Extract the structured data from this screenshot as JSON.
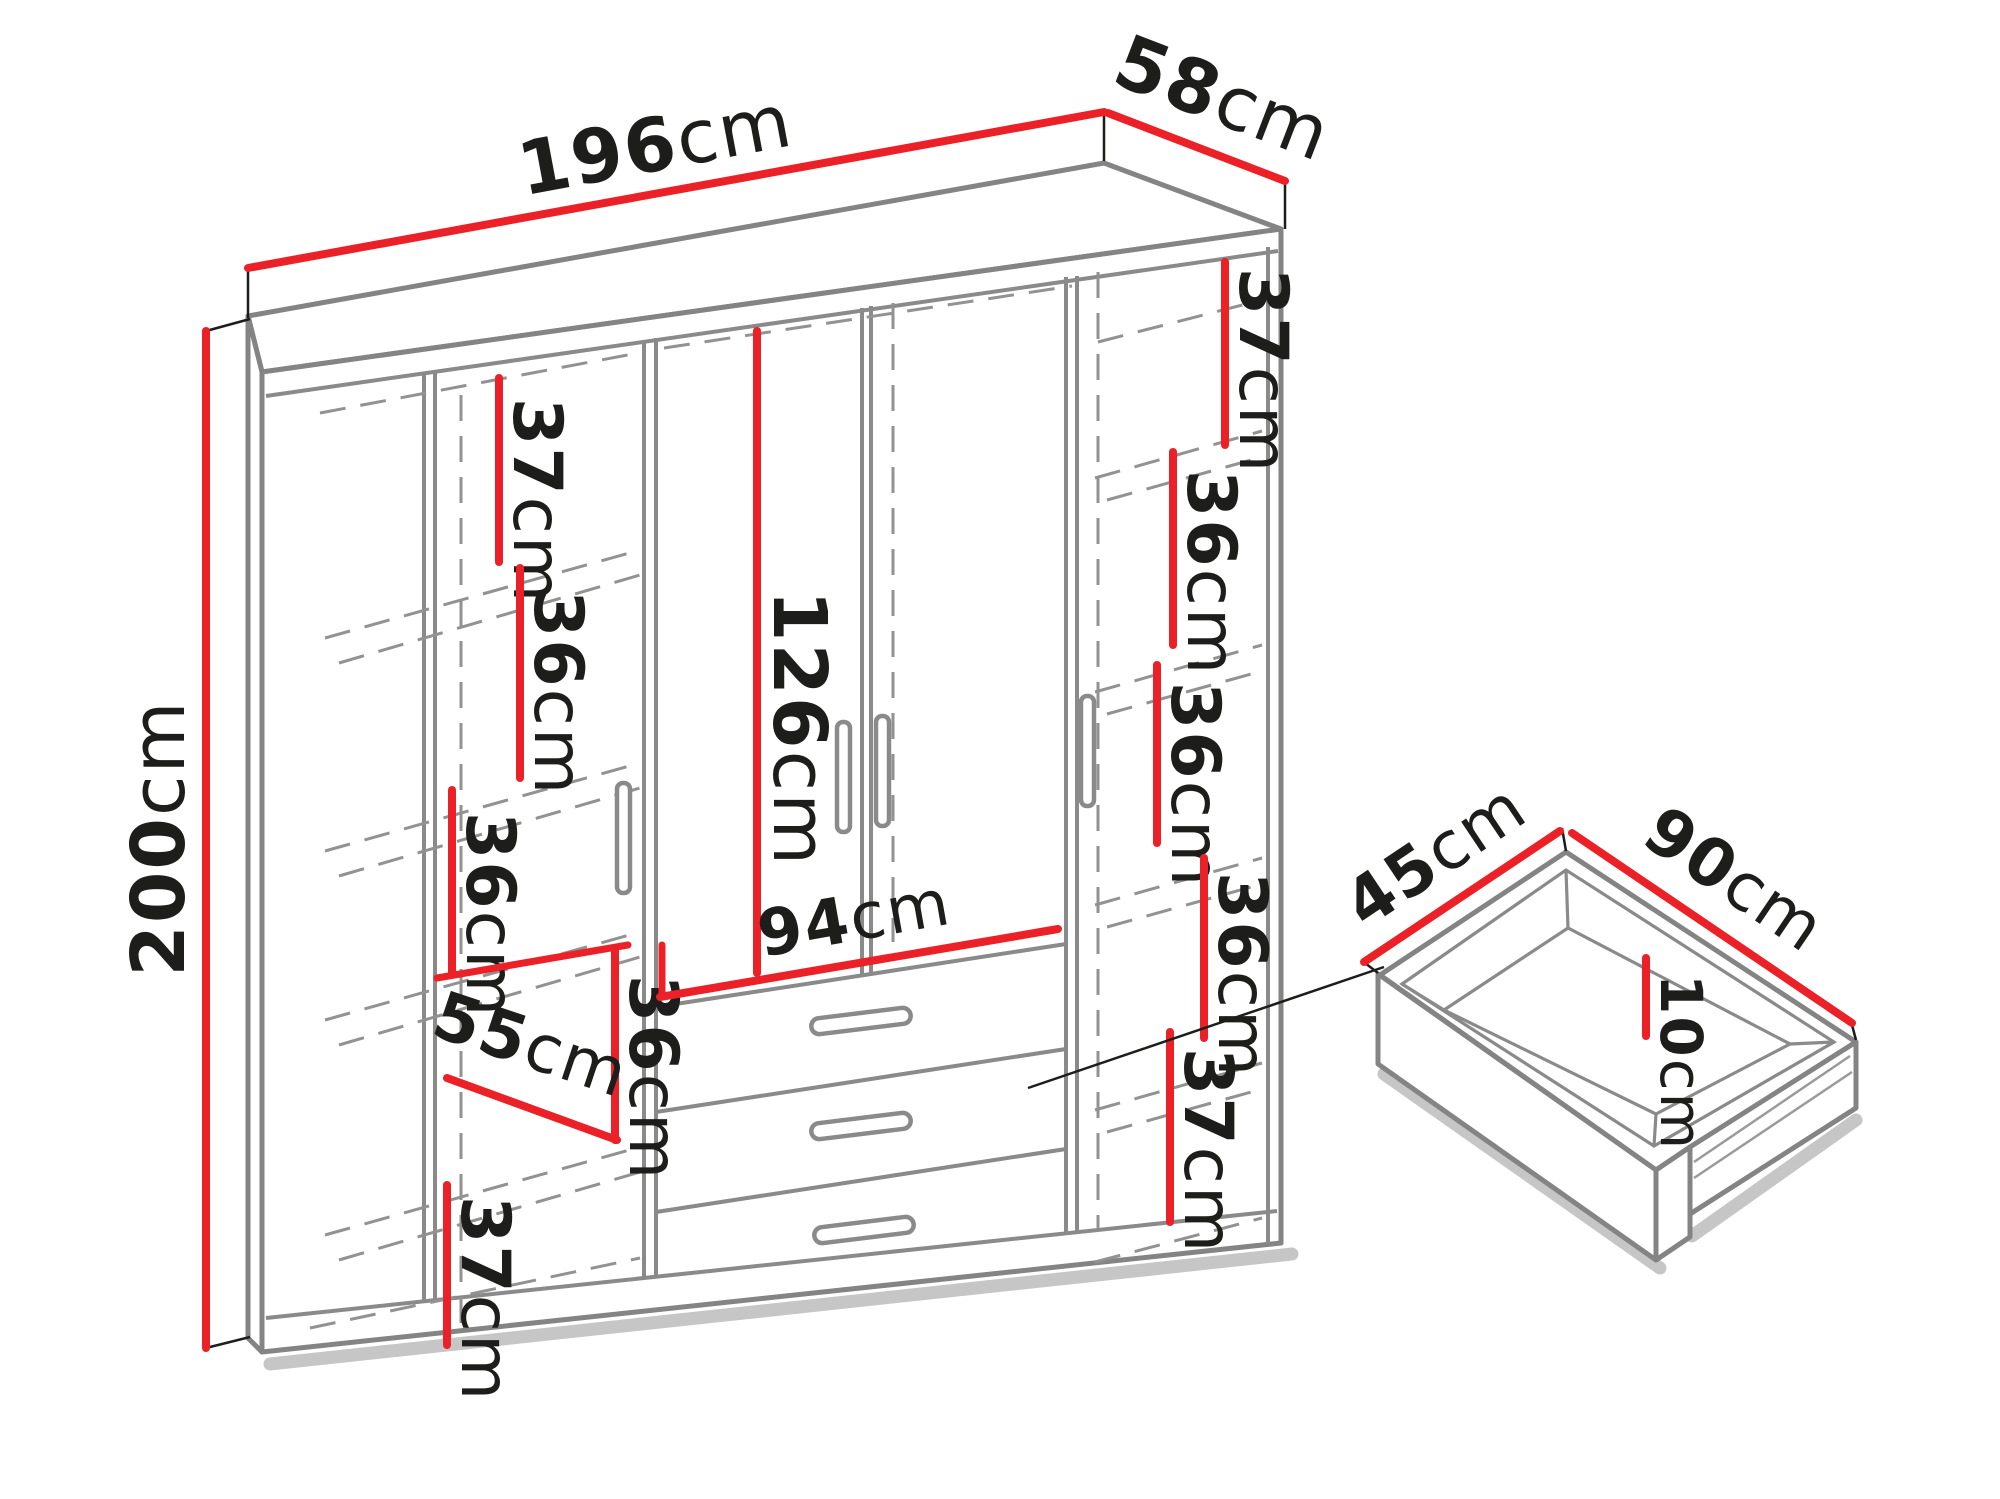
{
  "diagram": {
    "type": "furniture-dimension-drawing",
    "subject": "four-door wardrobe with three drawers and pull-out drawer detail",
    "unit": "cm",
    "colors": {
      "dimension_line": "#ec2127",
      "outline_gray": "#848484",
      "hidden_line_gray": "#929292",
      "text": "#1d1d1b",
      "background": "#ffffff"
    },
    "wardrobe": {
      "width": {
        "num": "196",
        "unit": "cm"
      },
      "depth": {
        "num": "58",
        "unit": "cm"
      },
      "height": {
        "num": "200",
        "unit": "cm"
      },
      "left_column": {
        "shelf_space_1": {
          "num": "37",
          "unit": "cm"
        },
        "shelf_space_2": {
          "num": "36",
          "unit": "cm"
        },
        "shelf_space_3": {
          "num": "36",
          "unit": "cm"
        },
        "shelf_width": {
          "num": "55",
          "unit": "cm"
        },
        "shelf_space_4": {
          "num": "36",
          "unit": "cm"
        },
        "shelf_space_5": {
          "num": "37",
          "unit": "cm"
        }
      },
      "center_section": {
        "hanging_height": {
          "num": "126",
          "unit": "cm"
        },
        "drawer_width": {
          "num": "94",
          "unit": "cm"
        }
      },
      "right_column": {
        "shelf_space_1": {
          "num": "37",
          "unit": "cm"
        },
        "shelf_space_2": {
          "num": "36",
          "unit": "cm"
        },
        "shelf_space_3": {
          "num": "36",
          "unit": "cm"
        },
        "shelf_space_4": {
          "num": "36",
          "unit": "cm"
        },
        "shelf_space_5": {
          "num": "37",
          "unit": "cm"
        }
      }
    },
    "drawer_detail": {
      "depth": {
        "num": "45",
        "unit": "cm"
      },
      "width": {
        "num": "90",
        "unit": "cm"
      },
      "inner_height": {
        "num": "10",
        "unit": "cm"
      }
    }
  }
}
